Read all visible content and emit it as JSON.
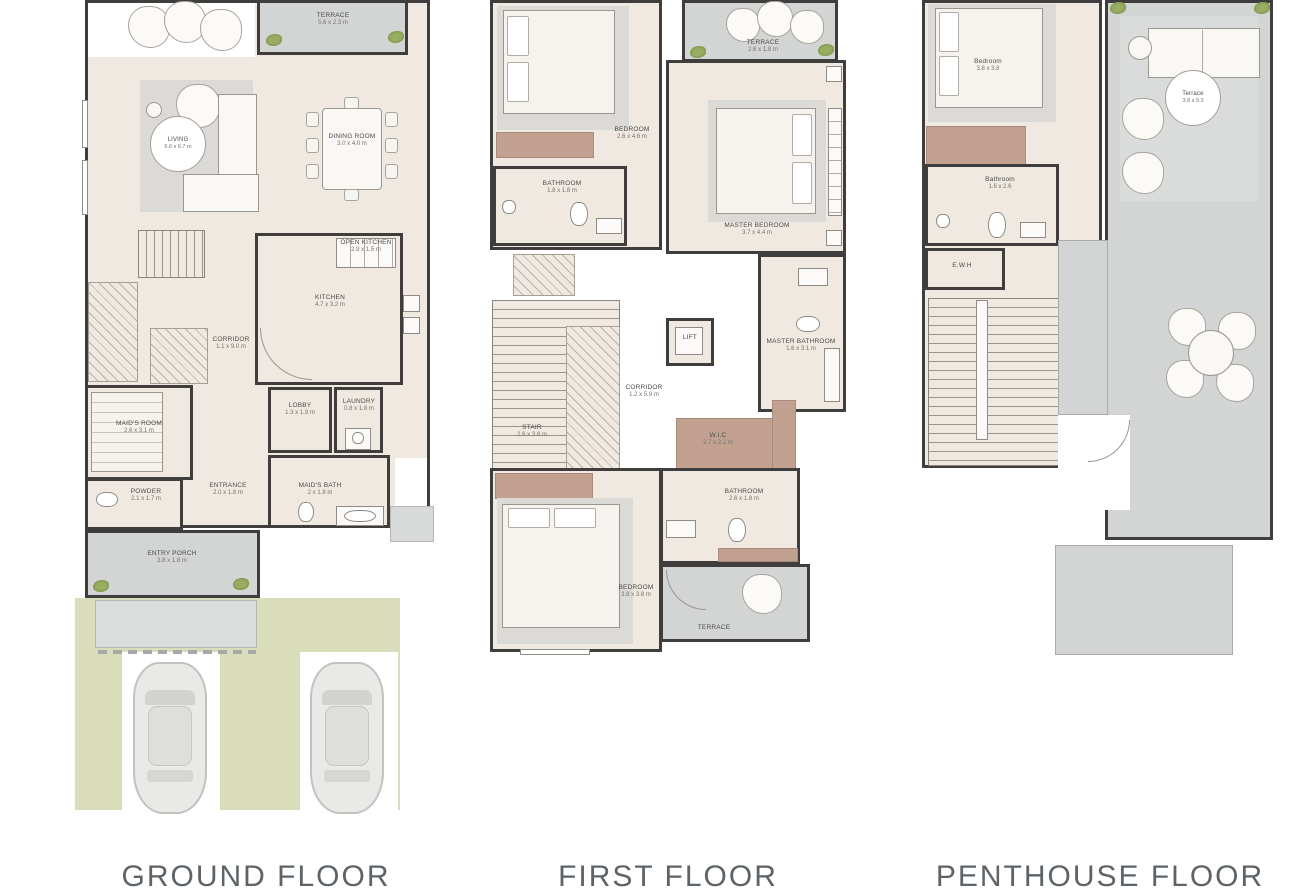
{
  "palette": {
    "wall": "#3f3e3c",
    "floor_beige": "#efe9e1",
    "terrace_gray": "#d2d5d3",
    "landscape_green": "#d9ddba",
    "accent_brown": "#c3a190",
    "label_text": "#4b4b48",
    "title_text": "#5d6367",
    "plant_green": "#9aae62"
  },
  "ground": {
    "title": "GROUND FLOOR",
    "terrace": {
      "name": "TERRACE",
      "dims": "5.6 x 2.3 m"
    },
    "living": {
      "name": "LIVING",
      "dims": "6.6 x 6.7 m"
    },
    "dining": {
      "name": "DINING ROOM",
      "dims": "3.0 x 4.0 m"
    },
    "open_kitchen": {
      "name": "OPEN KITCHEN",
      "dims": "2.9 x 1.5 m"
    },
    "kitchen": {
      "name": "KITCHEN",
      "dims": "4.7 x 3.2 m"
    },
    "corridor": {
      "name": "CORRIDOR",
      "dims": "1.1 x 9.0 m"
    },
    "maids_room": {
      "name": "MAID'S ROOM",
      "dims": "2.6 x 3.1 m"
    },
    "powder": {
      "name": "POWDER",
      "dims": "2.1 x 1.7 m"
    },
    "entrance": {
      "name": "ENTRANCE",
      "dims": "2.0 x 1.8 m"
    },
    "lobby": {
      "name": "LOBBY",
      "dims": "1.3 x 1.9 m"
    },
    "laundry": {
      "name": "LAUNDRY",
      "dims": "0.8 x 1.8 m"
    },
    "maids_bath": {
      "name": "MAID'S BATH",
      "dims": "2 x 1.8 m"
    },
    "entry_porch": {
      "name": "ENTRY PORCH",
      "dims": "3.8 x 1.8 m"
    }
  },
  "first": {
    "title": "FIRST FLOOR",
    "terrace_top": {
      "name": "TERRACE",
      "dims": "2.6 x 1.8 m"
    },
    "bedroom_top": {
      "name": "BEDROOM",
      "dims": "2.6 x 4.6 m"
    },
    "master_bedroom": {
      "name": "MASTER BEDROOM",
      "dims": "3.7 x 4.4 m"
    },
    "bathroom_top": {
      "name": "BATHROOM",
      "dims": "1.8 x 1.8 m"
    },
    "lift": {
      "name": "LIFT",
      "dims": ""
    },
    "corridor": {
      "name": "CORRIDOR",
      "dims": "1.2 x 5.9 m"
    },
    "stair": {
      "name": "STAIR",
      "dims": "2.6 x 3.8 m"
    },
    "master_bathroom": {
      "name": "MASTER BATHROOM",
      "dims": "1.6 x 3.1 m"
    },
    "wic": {
      "name": "W.I.C",
      "dims": "2.7 x 2.2 m"
    },
    "bathroom_bottom": {
      "name": "BATHROOM",
      "dims": "2.6 x 1.8 m"
    },
    "bedroom_bottom": {
      "name": "BEDROOM",
      "dims": "3.8 x 3.8 m"
    },
    "terrace_bottom": {
      "name": "TERRACE",
      "dims": ""
    }
  },
  "penthouse": {
    "title": "PENTHOUSE FLOOR",
    "bedroom": {
      "name": "Bedroom",
      "dims": "3.8 x 3.8"
    },
    "terrace": {
      "name": "Terrace",
      "dims": "3.8 x 9.3"
    },
    "bathroom": {
      "name": "Bathroom",
      "dims": "1.6 x 2.6"
    },
    "ewh": {
      "name": "E.W.H",
      "dims": ""
    }
  }
}
